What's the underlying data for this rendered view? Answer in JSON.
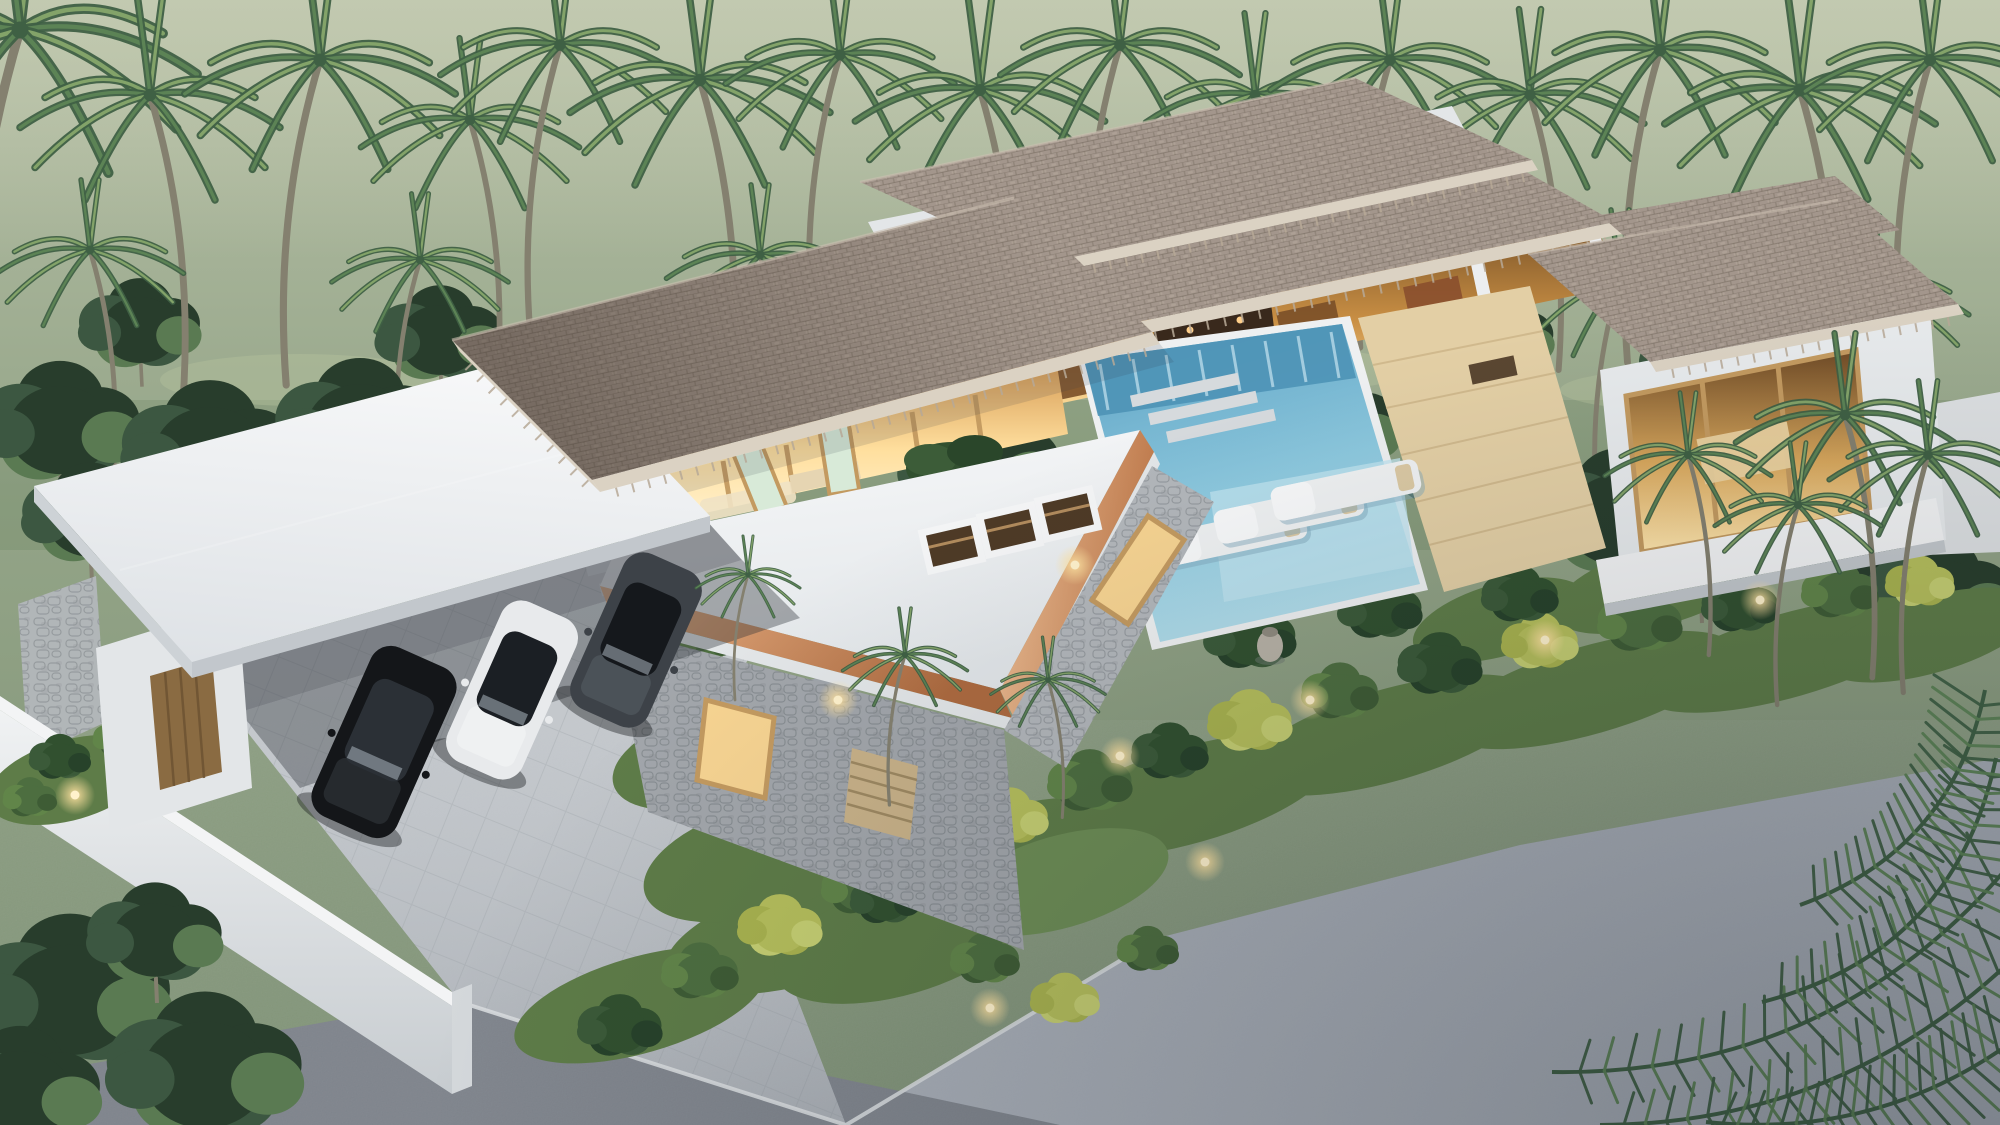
{
  "meta": {
    "description": "Aerial dusk 3D rendering of a modern tropical villa: layered brown shingle roofs, warm glowing interiors, turquoise swimming pool with three white sun loungers, white flat roofs with copper fascia, stone-clad wing, carport with three parked cars, white perimeter wall, lush palm garden, coconut forest behind and gray asphalt roads in front.",
    "time_of_day": "dusk",
    "stats": {
      "cars_visible": 3,
      "sun_loungers": 3,
      "roof_skylights": 3,
      "pools": 1
    }
  },
  "scene": {
    "palette": {
      "field_top": "#b6bfa6",
      "field_mid": "#93a487",
      "field_low": "#7e9175",
      "tree_dark": "#283d2c",
      "tree_mid": "#3c5741",
      "tree_light": "#5a7a52",
      "palm_dark": "#3f6044",
      "palm_mid": "#5c8355",
      "palm_light": "#83a369",
      "trunk": "#84806f",
      "shingle_base": "#a3968c",
      "shingle_dark": "#73675c",
      "shingle_light": "#c4b8ab",
      "fascia": "#dbd2c3",
      "white_top": "#f3f4f5",
      "white_face": "#e3e6e8",
      "white_shadow": "#c4c9cd",
      "copper": "#d0905f",
      "copper_dark": "#b06e44",
      "copper_light": "#eab88d",
      "stone": "#b3b7bb",
      "stone_dark": "#8f9499",
      "glass_warm": "#f7d492",
      "glass_green": "#d8ead8",
      "glow": "#ffb95e",
      "wood_frame": "#c39a60",
      "wood_dark": "#8a6b42",
      "wood_deck": "#e3cfa5",
      "wood_floor": "#caa06b",
      "pool_light": "#b7e0ec",
      "pool_mid": "#8cc8de",
      "pool_deep": "#5fa3c4",
      "lounger": "#eff1f2",
      "paving": "#c7cbcf",
      "paving_line": "#b2b6bb",
      "walkway": "#a0a5ab",
      "step": "#d6dadd",
      "asphalt": "#a6acb5",
      "asphalt_dark": "#7d828a",
      "lawn": "#5e7c48",
      "lawn_dark": "#445f36",
      "shrub_yellow": "#b6bf5c",
      "shrub_green": "#4d6e40",
      "plant_dark": "#31502f",
      "light_glow": "#ffd98f",
      "car_black": "#141619",
      "car_white": "#e8eaec",
      "car_gray": "#3d4248"
    },
    "trees": {
      "canopy_palms": [
        [
          20,
          30,
          1.7,
          1
        ],
        [
          150,
          95,
          1.25,
          -1
        ],
        [
          320,
          60,
          1.3,
          1
        ],
        [
          470,
          120,
          1.05,
          -1
        ],
        [
          560,
          45,
          1.15,
          1
        ],
        [
          700,
          80,
          1.25,
          -1
        ],
        [
          840,
          55,
          1.1,
          1
        ],
        [
          980,
          90,
          1.2,
          -1
        ],
        [
          1120,
          45,
          1.15,
          1
        ],
        [
          1255,
          95,
          1.05,
          -1
        ],
        [
          1390,
          60,
          1.15,
          1
        ],
        [
          1530,
          95,
          1.1,
          -1
        ],
        [
          1660,
          50,
          1.25,
          1
        ],
        [
          1800,
          90,
          1.3,
          -1
        ],
        [
          1930,
          60,
          1.2,
          1
        ]
      ],
      "field_palms": [
        [
          90,
          250,
          0.9,
          -1
        ],
        [
          420,
          260,
          0.85,
          1
        ],
        [
          760,
          255,
          0.9,
          -1
        ],
        [
          1060,
          260,
          0.85,
          1
        ],
        [
          1340,
          270,
          0.8,
          -1
        ],
        [
          1620,
          280,
          0.9,
          1
        ],
        [
          1870,
          290,
          0.95,
          -1
        ]
      ],
      "back_row": [
        [
          140,
          330,
          0.9
        ],
        [
          440,
          340,
          0.95
        ],
        [
          740,
          330,
          0.9
        ],
        [
          1040,
          345,
          0.85
        ],
        [
          1500,
          340,
          0.8
        ],
        [
          1700,
          370,
          0.9
        ],
        [
          1840,
          390,
          0.95
        ]
      ],
      "mid_row": [
        [
          60,
          430,
          1.2
        ],
        [
          210,
          455,
          1.3
        ],
        [
          360,
          430,
          1.25
        ],
        [
          520,
          455,
          1.35
        ],
        [
          680,
          440,
          1.3
        ],
        [
          830,
          425,
          1.25
        ],
        [
          980,
          470,
          1.2
        ],
        [
          1180,
          420,
          1.0
        ],
        [
          1330,
          430,
          1.05
        ],
        [
          1480,
          475,
          1.15
        ],
        [
          1620,
          520,
          1.25
        ],
        [
          1760,
          500,
          1.2
        ],
        [
          1880,
          545,
          1.25
        ],
        [
          1960,
          500,
          1.0
        ]
      ],
      "edge_trees": [
        [
          1700,
          560,
          1.0
        ],
        [
          1940,
          600,
          1.1
        ],
        [
          90,
          520,
          1.0
        ],
        [
          250,
          540,
          0.9
        ]
      ],
      "foreground_corner": [
        [
          70,
          1000,
          1.5
        ],
        [
          205,
          1075,
          1.45
        ],
        [
          20,
          1095,
          1.2
        ],
        [
          155,
          940,
          1.0
        ]
      ]
    },
    "accent_palms": [
      [
        905,
        655,
        0.6,
        1
      ],
      [
        1048,
        680,
        0.55,
        -1
      ],
      [
        748,
        575,
        0.5,
        1
      ],
      [
        1688,
        455,
        0.8,
        -1
      ],
      [
        1845,
        415,
        1.05,
        -1
      ],
      [
        1928,
        455,
        0.95,
        1
      ],
      [
        1798,
        505,
        0.8,
        1
      ]
    ],
    "garden": {
      "lawn_patches": [
        [
          640,
          1005,
          130,
          48
        ],
        [
          810,
          930,
          150,
          52
        ],
        [
          1000,
          860,
          150,
          50
        ],
        [
          1190,
          795,
          150,
          48
        ],
        [
          1390,
          735,
          150,
          46
        ],
        [
          1590,
          690,
          150,
          44
        ],
        [
          1790,
          655,
          150,
          42
        ],
        [
          1930,
          635,
          110,
          38
        ],
        [
          70,
          780,
          85,
          40
        ],
        [
          1500,
          620,
          90,
          36
        ],
        [
          1660,
          585,
          110,
          40
        ],
        [
          760,
          860,
          120,
          55
        ],
        [
          900,
          940,
          130,
          55
        ],
        [
          700,
          760,
          90,
          45
        ]
      ],
      "shrubs": [
        [
          620,
          1030,
          1.1,
          "d"
        ],
        [
          700,
          975,
          1.0,
          "g"
        ],
        [
          780,
          930,
          1.1,
          "y"
        ],
        [
          860,
          890,
          1.0,
          "g"
        ],
        [
          935,
          855,
          1.2,
          "d"
        ],
        [
          1010,
          820,
          1.0,
          "y"
        ],
        [
          1090,
          785,
          1.1,
          "g"
        ],
        [
          1170,
          755,
          1.0,
          "d"
        ],
        [
          1250,
          725,
          1.1,
          "y"
        ],
        [
          1340,
          695,
          1.0,
          "g"
        ],
        [
          1440,
          668,
          1.1,
          "d"
        ],
        [
          1540,
          645,
          1.0,
          "y"
        ],
        [
          1640,
          625,
          1.1,
          "g"
        ],
        [
          1740,
          608,
          1.0,
          "d"
        ],
        [
          1840,
          594,
          1.0,
          "g"
        ],
        [
          1920,
          585,
          0.9,
          "y"
        ],
        [
          60,
          760,
          0.8,
          "d"
        ],
        [
          120,
          740,
          0.7,
          "g"
        ],
        [
          30,
          800,
          0.7,
          "g"
        ],
        [
          665,
          600,
          0.8,
          "d"
        ],
        [
          705,
          645,
          0.7,
          "g"
        ],
        [
          1250,
          640,
          1.2,
          "d"
        ],
        [
          1380,
          612,
          1.1,
          "d"
        ],
        [
          1520,
          598,
          1.0,
          "d"
        ],
        [
          680,
          700,
          0.9,
          "d"
        ],
        [
          735,
          762,
          0.8,
          "g"
        ],
        [
          805,
          832,
          0.9,
          "y"
        ],
        [
          885,
          902,
          0.9,
          "d"
        ],
        [
          985,
          962,
          0.9,
          "g"
        ],
        [
          1065,
          1002,
          0.9,
          "y"
        ],
        [
          1148,
          952,
          0.8,
          "g"
        ]
      ],
      "lights": [
        [
          75,
          795
        ],
        [
          838,
          700
        ],
        [
          1120,
          756
        ],
        [
          1310,
          700
        ],
        [
          990,
          1008
        ],
        [
          1205,
          862
        ],
        [
          1545,
          640
        ],
        [
          1760,
          600
        ],
        [
          1075,
          565
        ]
      ]
    },
    "pool": {
      "loungers": [
        [
          1232,
          536
        ],
        [
          1289,
          513
        ],
        [
          1346,
          490
        ]
      ]
    },
    "skylights": [
      [
        952,
        546
      ],
      [
        1010,
        530
      ],
      [
        1068,
        514
      ]
    ],
    "cars": [
      {
        "name": "car-suv-gray",
        "cx": 636,
        "cy": 640,
        "w": 84,
        "h": 170,
        "rot": 24,
        "body": "#3d4248",
        "glass": "#15181c",
        "accent": "#5a6168"
      },
      {
        "name": "car-sedan-white",
        "cx": 512,
        "cy": 690,
        "w": 82,
        "h": 175,
        "rot": 24,
        "body": "#e8eaec",
        "glass": "#1b1f24",
        "accent": "#f6f7f8"
      },
      {
        "name": "car-suv-black",
        "cx": 384,
        "cy": 742,
        "w": 92,
        "h": 185,
        "rot": 24,
        "body": "#141619",
        "glass": "#2b3036",
        "accent": "#383d43"
      }
    ],
    "overhanging_fronds": [
      {
        "x0": 2012,
        "y0": 862,
        "x1": 1552,
        "y1": 1072,
        "bend": -120
      },
      {
        "x0": 2016,
        "y0": 956,
        "x1": 1600,
        "y1": 1125,
        "bend": -90
      },
      {
        "x0": 2012,
        "y0": 1042,
        "x1": 1706,
        "y1": 1122,
        "bend": -60
      },
      {
        "x0": 1996,
        "y0": 758,
        "x1": 1762,
        "y1": 1002,
        "bend": -105
      },
      {
        "x0": 1985,
        "y0": 690,
        "x1": 1800,
        "y1": 905,
        "bend": -80
      }
    ],
    "rafter_edges": [
      [
        600,
        492,
        1160,
        344,
        34,
        "ticksGable"
      ],
      [
        460,
        352,
        600,
        492,
        11,
        "ticksGable"
      ],
      [
        982,
        368,
        1622,
        234,
        36,
        "ticksB"
      ],
      [
        1046,
        274,
        1538,
        170,
        30,
        "ticksA"
      ],
      [
        1656,
        372,
        1964,
        314,
        18,
        "ticksPav"
      ]
    ]
  }
}
